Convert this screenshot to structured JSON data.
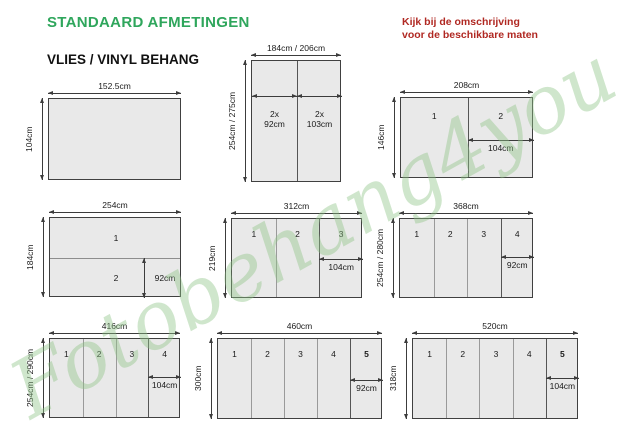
{
  "page": {
    "title": "STANDAARD AFMETINGEN",
    "subtitle": "VLIES / VINYL BEHANG",
    "note": [
      "Kijk bij de omschrijving",
      "voor de beschikbare maten"
    ],
    "watermark": "Fotobehang4you"
  },
  "colors": {
    "title_green": "#2fa65c",
    "note_red": "#b02822",
    "panel_fill": "#e9e9e9",
    "outline": "#404040",
    "line": "#3c3c3c",
    "divider": "#9a9a9a",
    "watermark_green": "#8fc487"
  },
  "figures": [
    {
      "name": "152x104",
      "type": "plain",
      "width_label": "152.5cm",
      "height_label": "104cm",
      "layout": {
        "x": 48,
        "y": 98,
        "w": 133,
        "h": 82
      }
    },
    {
      "name": "184-206x254-275",
      "type": "double",
      "width_label": "184cm / 206cm",
      "height_label": "254cm / 275cm",
      "columns": [
        {
          "lines": [
            "2x",
            "92cm"
          ]
        },
        {
          "lines": [
            "2x",
            "103cm"
          ]
        }
      ],
      "layout": {
        "x": 251,
        "y": 60,
        "w": 90,
        "h": 122,
        "arrow_y": 0.285,
        "label_y": 0.39
      }
    },
    {
      "name": "208x146",
      "type": "columns",
      "width_label": "208cm",
      "height_label": "146cm",
      "panels": [
        "1",
        "2"
      ],
      "inner_label": "104cm",
      "layout": {
        "x": 400,
        "y": 97,
        "w": 133,
        "h": 81,
        "arrow_y": 0.52,
        "num_y": 0.16
      }
    },
    {
      "name": "254x184",
      "type": "rows",
      "width_label": "254cm",
      "height_label": "184cm",
      "panels": [
        "1",
        "2"
      ],
      "inner_label": "92cm",
      "layout": {
        "x": 49,
        "y": 217,
        "w": 132,
        "h": 80,
        "arrow_x": 0.715
      }
    },
    {
      "name": "312x219",
      "type": "columns",
      "width_label": "312cm",
      "height_label": "219cm",
      "panels": [
        "1",
        "2",
        "3"
      ],
      "inner_label": "104cm",
      "layout": {
        "x": 231,
        "y": 218,
        "w": 131,
        "h": 80,
        "arrow_y": 0.5,
        "num_y": 0.12
      }
    },
    {
      "name": "368x254-280",
      "type": "columns",
      "width_label": "368cm",
      "height_label": "254cm / 280cm",
      "panels": [
        "1",
        "2",
        "3",
        "4"
      ],
      "inner_label": "92cm",
      "layout": {
        "x": 399,
        "y": 218,
        "w": 134,
        "h": 80,
        "arrow_y": 0.48,
        "num_y": 0.12
      }
    },
    {
      "name": "416x254-290",
      "type": "columns",
      "width_label": "416cm",
      "height_label": "254cm / 290cm",
      "panels": [
        "1",
        "2",
        "3",
        "4"
      ],
      "inner_label": "104cm",
      "layout": {
        "x": 49,
        "y": 338,
        "w": 131,
        "h": 80,
        "arrow_y": 0.475,
        "num_y": 0.12
      }
    },
    {
      "name": "460x300",
      "type": "columns",
      "width_label": "460cm",
      "height_label": "300cm",
      "panels": [
        "1",
        "2",
        "3",
        "4",
        "5"
      ],
      "last_bold": true,
      "inner_label": "92cm",
      "layout": {
        "x": 217,
        "y": 338,
        "w": 165,
        "h": 81,
        "arrow_y": 0.5,
        "num_y": 0.12
      }
    },
    {
      "name": "520x318",
      "type": "columns",
      "width_label": "520cm",
      "height_label": "318cm",
      "panels": [
        "1",
        "2",
        "3",
        "4",
        "5"
      ],
      "last_bold": true,
      "inner_label": "104cm",
      "layout": {
        "x": 412,
        "y": 338,
        "w": 166,
        "h": 81,
        "arrow_y": 0.48,
        "num_y": 0.12
      }
    }
  ]
}
